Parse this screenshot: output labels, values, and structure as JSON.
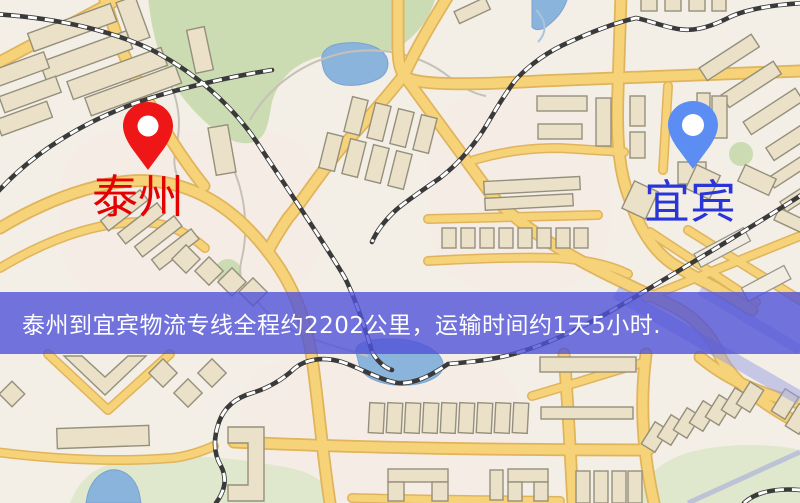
{
  "map": {
    "markers": [
      {
        "id": "taizhou",
        "label": "泰州",
        "label_color": "#e60000",
        "pin_color": "#ee1616"
      },
      {
        "id": "yibin",
        "label": "宜宾",
        "label_color": "#2a35d8",
        "pin_color": "#5b8df2"
      }
    ],
    "palette": {
      "background": "#f3efe7",
      "road_yellow": "#f6d278",
      "road_casing": "#e0b45c",
      "building": "#eae1c8",
      "park_green": "#cbdbb2",
      "pale_green": "#dfe7cc",
      "water_blue": "#8ab4dc",
      "railway_dark": "#3a3a3a",
      "lavender_road": "#9aa0e2"
    }
  },
  "banner": {
    "text": "泰州到宜宾物流专线全程约2202公里，运输时间约1天5小时.",
    "background": "#5052d8",
    "text_color": "#ffffff"
  }
}
